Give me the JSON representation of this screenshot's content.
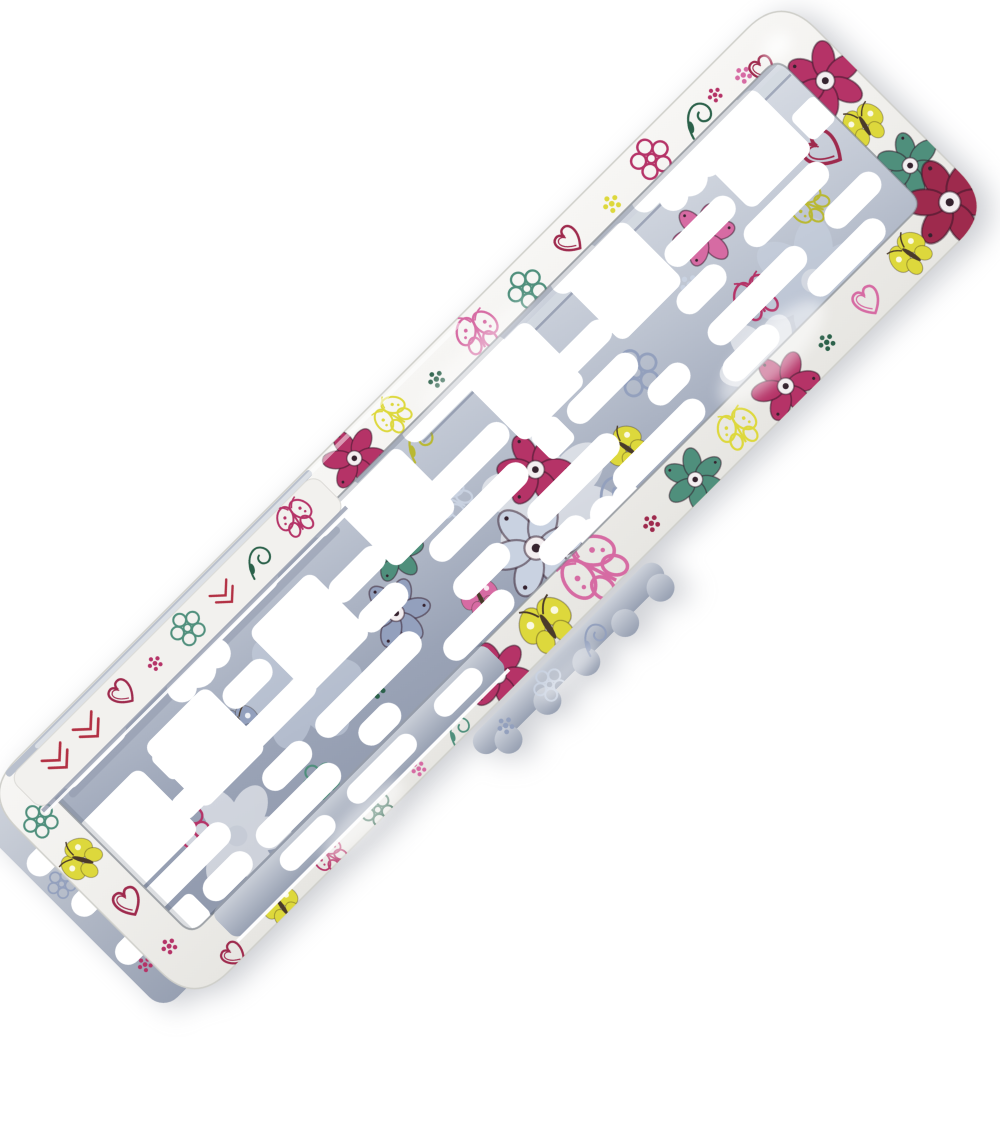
{
  "scene": {
    "description": "Product photograph of a decorative car number-plate holder, lying diagonally at 45 degrees on a plain white background",
    "product": "License plate frame with floral doodle print (flowers, butterflies, hearts, chevrons)",
    "background_color": "#ffffff",
    "rotation_deg": -45,
    "finish": "glossy plastic",
    "parts": {
      "front_frame": "white frame ring printed with colorful doodle flowers and butterflies",
      "back_plate": "silver-blue metallic mounting plate printed with the same pattern, perforated with slots and square holes",
      "accent_band": "light printed band with red chevrons and sketched hearts (offset layered plate edge)",
      "bottom_clip": "scallop-edged silver clip strip protruding below the frame",
      "left_edge_layer": "silver plate edge protruding past the left end of the frame"
    }
  },
  "palette": {
    "background": "#ffffff",
    "frame_base": "#f0efec",
    "band_base": "#f2f1ee",
    "silver_light": "#dde1e8",
    "silver_mid": "#aab2c2",
    "silver_dark": "#8d96aa",
    "magenta": "#b53367",
    "crimson": "#9e2a4d",
    "red": "#b23043",
    "pink": "#d66ba3",
    "yellow": "#ddd83c",
    "olive": "#b9b832",
    "teal": "#4f8f7c",
    "dark_green": "#2b614a",
    "blue_grey": "#93a0bd",
    "pale_blue": "#c9d2e1",
    "white": "#ffffff"
  },
  "pattern_motifs_legend": {
    "f6": "six-petal filled flower",
    "f5o": "five-petal outline flower",
    "bf": "filled butterfly",
    "bfo": "outline butterfly with dotted wings",
    "ht": "sketched double-line heart",
    "cv": "red chevron zigzag",
    "df": "dot flower cluster",
    "sw": "vine swirl with leaf",
    "gf": "translucent ghost flower"
  },
  "motifs": [
    [
      "f6",
      "frame",
      500,
      26,
      1.0,
      10,
      "magenta"
    ],
    [
      "bfo",
      "frame",
      558,
      24,
      0.9,
      -15,
      "yellow"
    ],
    [
      "df",
      "frame",
      614,
      28,
      0.8,
      0,
      "dark_green"
    ],
    [
      "bfo",
      "frame",
      676,
      26,
      1.05,
      20,
      "pink"
    ],
    [
      "f5o",
      "frame",
      742,
      28,
      0.95,
      0,
      "teal"
    ],
    [
      "ht",
      "frame",
      806,
      24,
      0.95,
      -10,
      "crimson"
    ],
    [
      "df",
      "frame",
      862,
      28,
      0.85,
      0,
      "yellow"
    ],
    [
      "f5o",
      "frame",
      922,
      24,
      1.0,
      15,
      "magenta"
    ],
    [
      "sw",
      "frame",
      986,
      28,
      1.0,
      0,
      "dark_green"
    ],
    [
      "df",
      "frame",
      1046,
      30,
      0.8,
      0,
      "pink"
    ],
    [
      "df",
      "frame",
      1012,
      24,
      0.7,
      0,
      "magenta"
    ],
    [
      "f6",
      "frame",
      1100,
      92,
      1.25,
      -20,
      "magenta"
    ],
    [
      "bf",
      "frame",
      1096,
      152,
      1.0,
      15,
      "yellow"
    ],
    [
      "f6",
      "frame",
      1100,
      212,
      1.05,
      30,
      "teal"
    ],
    [
      "ht",
      "frame",
      1064,
      40,
      0.9,
      10,
      "crimson"
    ],
    [
      "f6",
      "frame",
      1102,
      266,
      1.45,
      15,
      "crimson"
    ],
    [
      "ht",
      "frame",
      64,
      292,
      0.85,
      -10,
      "crimson"
    ],
    [
      "bf",
      "frame",
      132,
      292,
      0.9,
      10,
      "yellow"
    ],
    [
      "bfo",
      "frame",
      202,
      291,
      0.8,
      -15,
      "magenta"
    ],
    [
      "f5o",
      "frame",
      268,
      291,
      0.8,
      0,
      "dark_green"
    ],
    [
      "df",
      "frame",
      326,
      291,
      0.7,
      0,
      "pink"
    ],
    [
      "sw",
      "frame",
      384,
      291,
      0.8,
      0,
      "teal"
    ],
    [
      "f6",
      "frame",
      448,
      281,
      1.1,
      20,
      "magenta"
    ],
    [
      "bf",
      "frame",
      518,
      282,
      1.3,
      12,
      "yellow"
    ],
    [
      "bfo",
      "frame",
      592,
      276,
      1.6,
      -18,
      "pink"
    ],
    [
      "df",
      "frame",
      664,
      282,
      0.8,
      0,
      "crimson"
    ],
    [
      "f6",
      "frame",
      726,
      282,
      1.0,
      -25,
      "teal"
    ],
    [
      "bfo",
      "frame",
      792,
      278,
      1.0,
      15,
      "yellow"
    ],
    [
      "f6",
      "frame",
      856,
      280,
      1.1,
      0,
      "magenta"
    ],
    [
      "df",
      "frame",
      916,
      278,
      0.8,
      0,
      "dark_green"
    ],
    [
      "ht",
      "frame",
      974,
      278,
      1.0,
      12,
      "pink"
    ],
    [
      "bf",
      "frame",
      1038,
      276,
      1.0,
      -12,
      "yellow"
    ],
    [
      "bf",
      "frame",
      24,
      118,
      1.0,
      -30,
      "yellow"
    ],
    [
      "ht",
      "frame",
      26,
      180,
      1.0,
      15,
      "crimson"
    ],
    [
      "df",
      "frame",
      24,
      240,
      0.75,
      0,
      "magenta"
    ],
    [
      "f5o",
      "frame",
      22,
      60,
      0.85,
      0,
      "teal"
    ],
    [
      "gf",
      "plate",
      300,
      150,
      1.5,
      0,
      "pale_blue"
    ],
    [
      "gf",
      "plate",
      610,
      196,
      1.7,
      25,
      "white"
    ],
    [
      "gf",
      "plate",
      950,
      225,
      1.5,
      -15,
      "pale_blue"
    ],
    [
      "gf",
      "plate",
      150,
      210,
      1.3,
      10,
      "white"
    ],
    [
      "gf",
      "plate",
      860,
      252,
      1.2,
      0,
      "white"
    ],
    [
      "f6",
      "plate",
      420,
      165,
      1.1,
      0,
      "blue_grey"
    ],
    [
      "f5o",
      "plate",
      760,
      165,
      1.15,
      20,
      "blue_grey"
    ],
    [
      "bfo",
      "plate",
      540,
      125,
      1.0,
      -20,
      "pale_blue"
    ],
    [
      "sw",
      "plate",
      660,
      235,
      1.25,
      0,
      "blue_grey"
    ],
    [
      "df",
      "plate",
      860,
      140,
      0.9,
      0,
      "pale_blue"
    ],
    [
      "bf",
      "plate",
      230,
      135,
      0.95,
      25,
      "blue_grey"
    ],
    [
      "f6",
      "plate",
      620,
      162,
      1.2,
      15,
      "magenta"
    ],
    [
      "ht",
      "plate",
      1050,
      140,
      1.35,
      -15,
      "crimson"
    ],
    [
      "f6",
      "plate",
      462,
      120,
      0.95,
      0,
      "teal"
    ],
    [
      "df",
      "plate",
      352,
      205,
      0.85,
      0,
      "dark_green"
    ],
    [
      "bf",
      "plate",
      700,
      212,
      1.0,
      -10,
      "yellow"
    ],
    [
      "bfo",
      "plate",
      898,
      198,
      1.1,
      15,
      "magenta"
    ],
    [
      "f5o",
      "plate",
      122,
      170,
      1.0,
      0,
      "magenta"
    ],
    [
      "sw",
      "plate",
      560,
      60,
      1.0,
      0,
      "olive"
    ],
    [
      "f6",
      "plate",
      905,
      115,
      1.0,
      0,
      "pink"
    ],
    [
      "bfo",
      "plate",
      1002,
      170,
      0.95,
      -25,
      "olive"
    ],
    [
      "df",
      "plate",
      58,
      140,
      0.8,
      0,
      "crimson"
    ],
    [
      "f5o",
      "plate",
      248,
      230,
      0.9,
      0,
      "teal"
    ],
    [
      "bf",
      "plate",
      490,
      215,
      0.9,
      18,
      "pink"
    ],
    [
      "f6",
      "plate",
      565,
      218,
      1.55,
      0,
      "pale_blue"
    ],
    [
      "cv",
      "band",
      78,
      30,
      1.0,
      0,
      "red"
    ],
    [
      "cv",
      "band",
      122,
      30,
      1.0,
      0,
      "red"
    ],
    [
      "ht",
      "band",
      170,
      28,
      0.9,
      -8,
      "crimson"
    ],
    [
      "df",
      "band",
      214,
      30,
      0.7,
      0,
      "magenta"
    ],
    [
      "f5o",
      "band",
      262,
      28,
      0.85,
      0,
      "teal"
    ],
    [
      "cv",
      "band",
      312,
      31,
      0.9,
      0,
      "red"
    ],
    [
      "sw",
      "band",
      362,
      30,
      0.9,
      0,
      "dark_green"
    ],
    [
      "bfo",
      "band",
      416,
      28,
      0.9,
      12,
      "magenta"
    ],
    [
      "df",
      "back",
      418,
      322,
      0.8,
      0,
      "blue_grey"
    ],
    [
      "f5o",
      "back",
      478,
      324,
      0.8,
      0,
      "pale_blue"
    ],
    [
      "sw",
      "back",
      545,
      322,
      0.9,
      0,
      "blue_grey"
    ],
    [
      "df",
      "back",
      -6,
      236,
      0.7,
      0,
      "magenta"
    ],
    [
      "f5o",
      "back",
      -8,
      120,
      0.7,
      0,
      "blue_grey"
    ]
  ],
  "holes": {
    "squares": [
      [
        85,
        135,
        88
      ],
      [
        190,
        125,
        88
      ],
      [
        345,
        118,
        88
      ],
      [
        495,
        90,
        88
      ],
      [
        675,
        92,
        88
      ],
      [
        815,
        90,
        88
      ],
      [
        1000,
        88,
        88
      ]
    ],
    "pills": [
      [
        105,
        48,
        90
      ],
      [
        300,
        48,
        130
      ],
      [
        450,
        48,
        70
      ],
      [
        620,
        48,
        140
      ],
      [
        790,
        48,
        60
      ],
      [
        950,
        48,
        150
      ],
      [
        265,
        110,
        60
      ],
      [
        420,
        110,
        70
      ],
      [
        575,
        110,
        110
      ],
      [
        740,
        110,
        70
      ],
      [
        905,
        110,
        90
      ],
      [
        150,
        152,
        60
      ],
      [
        260,
        152,
        110
      ],
      [
        415,
        152,
        60
      ],
      [
        550,
        152,
        130
      ],
      [
        725,
        152,
        90
      ],
      [
        865,
        152,
        60
      ],
      [
        985,
        152,
        110
      ],
      [
        90,
        196,
        120
      ],
      [
        235,
        196,
        60
      ],
      [
        350,
        196,
        140
      ],
      [
        510,
        196,
        70
      ],
      [
        640,
        196,
        120
      ],
      [
        775,
        196,
        50
      ],
      [
        900,
        196,
        130
      ],
      [
        1035,
        196,
        70
      ],
      [
        115,
        232,
        60
      ],
      [
        215,
        232,
        110
      ],
      [
        330,
        232,
        50
      ],
      [
        470,
        232,
        90
      ],
      [
        590,
        232,
        60
      ],
      [
        725,
        232,
        120
      ],
      [
        855,
        232,
        70
      ],
      [
        990,
        232,
        100
      ],
      [
        -4,
        90,
        36
      ],
      [
        -4,
        150,
        30
      ],
      [
        -4,
        215,
        36
      ]
    ],
    "small_squares": [
      [
        160,
        110
      ],
      [
        655,
        152
      ],
      [
        1065,
        110
      ],
      [
        60,
        232
      ],
      [
        520,
        70
      ]
    ],
    "clouds": [
      [
        935,
        64
      ],
      [
        240,
        64
      ],
      [
        640,
        246
      ]
    ]
  }
}
